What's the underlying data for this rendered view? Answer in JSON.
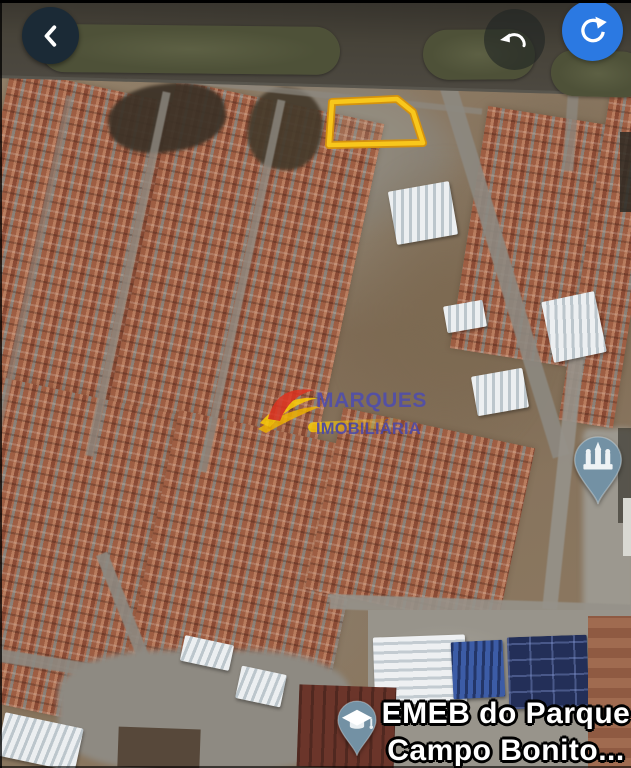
{
  "screen": {
    "width": 631,
    "height": 768,
    "view": "satellite-map"
  },
  "toolbar": {
    "back_icon": "chevron-left",
    "undo_icon": "undo-arrow",
    "refresh_icon": "refresh-arrow",
    "back_button_color": "#1b2a36",
    "refresh_button_color": "#2b79e2"
  },
  "property_lot": {
    "outline_color": "#f8c71c",
    "outline_edge_color": "#d4920e"
  },
  "watermark": {
    "line1": "MARQUES",
    "line2": "IMOBILIÁRIA",
    "text_color": "#4a4ab2",
    "accent_red": "#e03320",
    "accent_yellow": "#ffd103"
  },
  "pins": {
    "church": {
      "icon": "church-icon",
      "color": "#7391a4"
    },
    "school": {
      "icon": "graduation-cap-icon",
      "color": "#7391a4",
      "label_line1": "EMEB do Parque",
      "label_line2": "Campo Bonito..."
    }
  }
}
